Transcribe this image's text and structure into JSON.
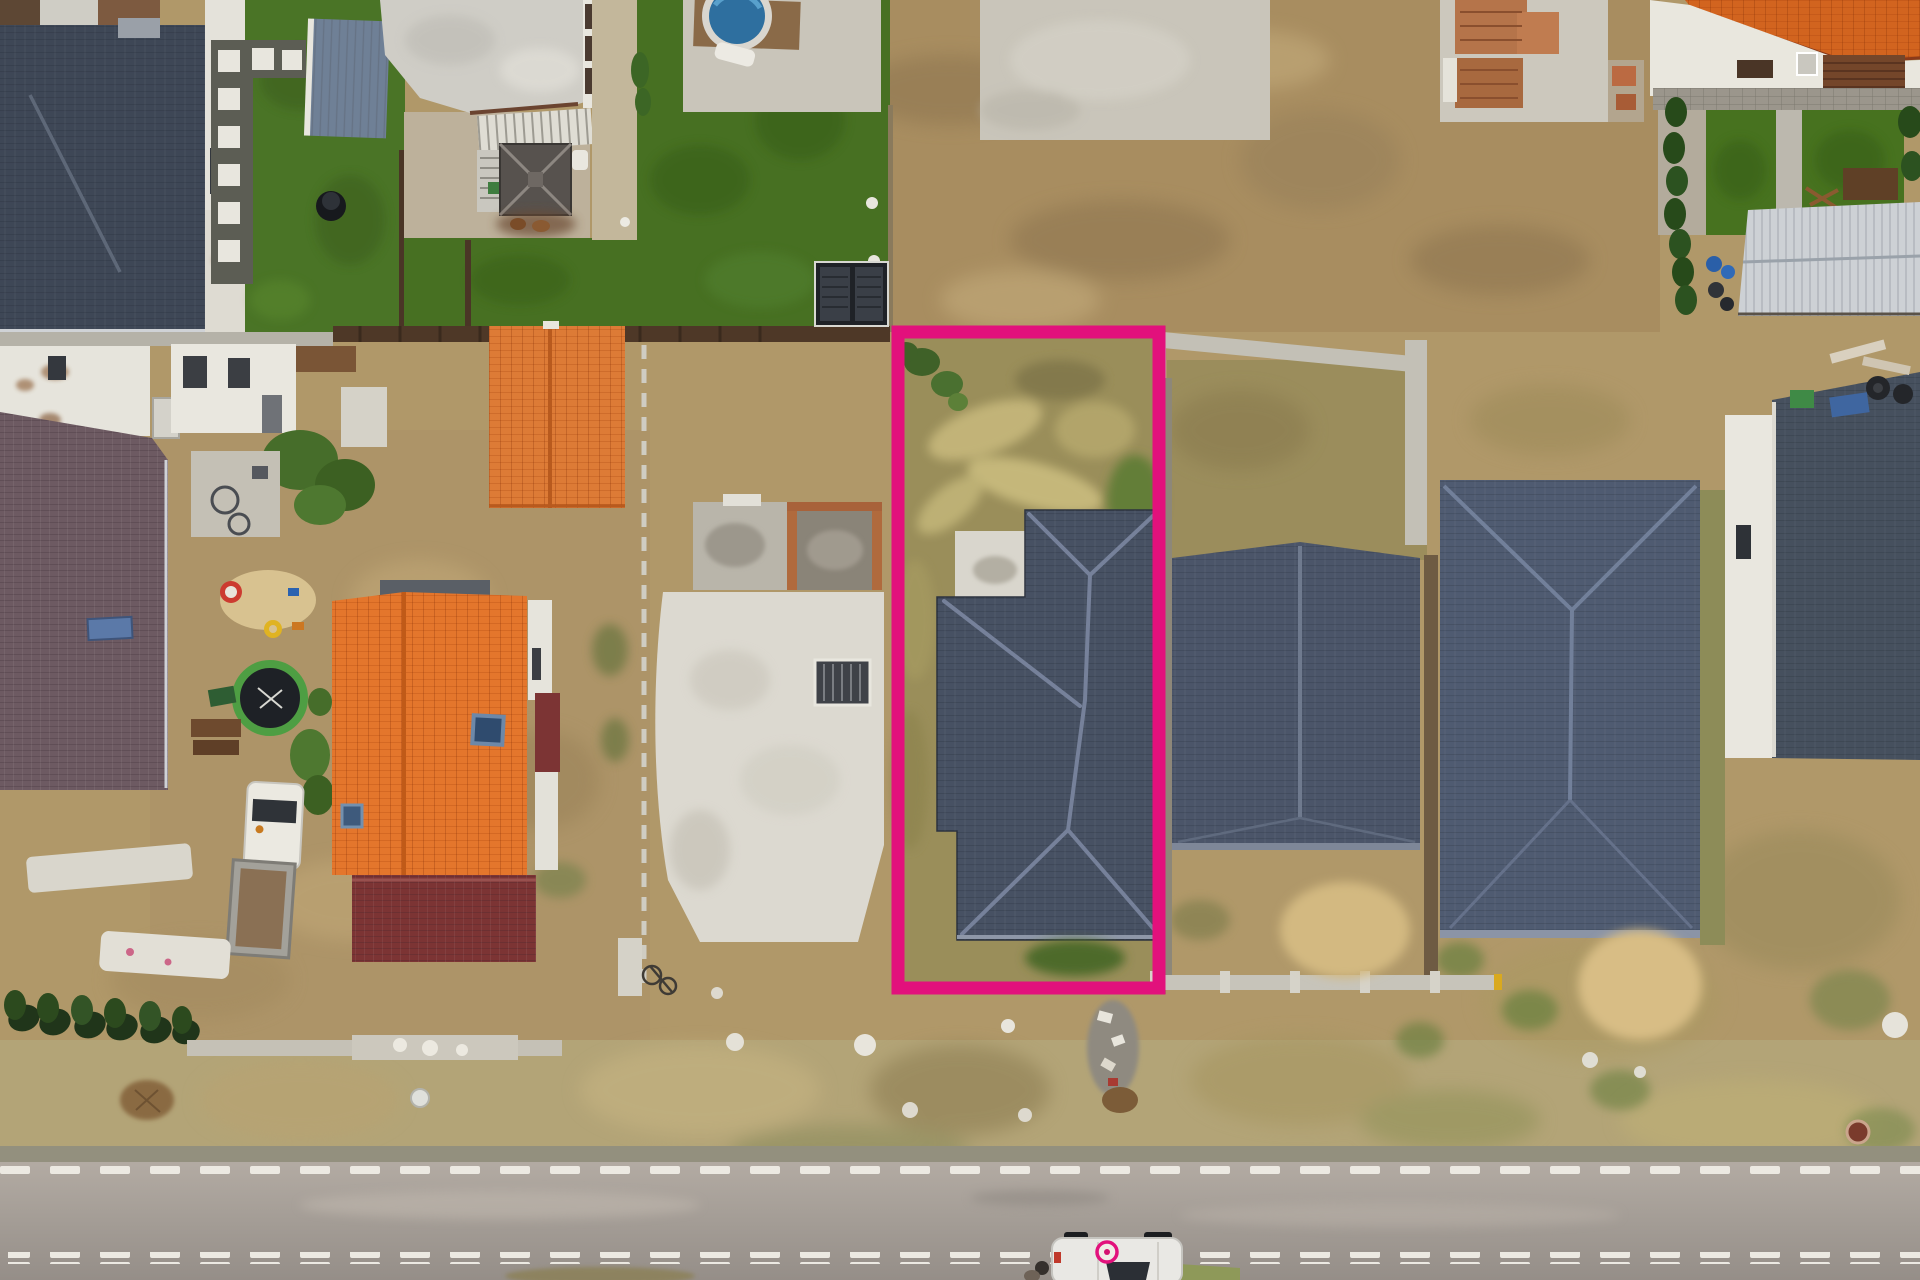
{
  "scene": {
    "type": "aerial-drone-photograph",
    "setting": "suburban residential street with new houses and empty plots, dry late-summer ground",
    "highlight": {
      "label": "for-sale plot boundary outline",
      "shape": "rectangle",
      "color": "#e2117c"
    },
    "road": {
      "surface": "asphalt",
      "dashed_marking_lines": 2,
      "marking_color": "#ece9e2"
    },
    "vehicles": [
      {
        "label": "white car parked on road",
        "roof_logo_color": "#d4126f"
      },
      {
        "label": "white truck with flatbed trailer in yard"
      }
    ],
    "features": [
      "dark-tile hip roof house top-left",
      "green lawns with stepping-stone path",
      "round pool on concrete pad",
      "black solar shed",
      "highlighted plot with house under construction (dark roof)",
      "two large dark-roof neighbor houses",
      "white house with dark roof far right",
      "big orange-tile roof house",
      "small orange-tile shed",
      "purple-brown tile roof house",
      "maroon porch roof",
      "concrete foundations and white slab under construction",
      "brick-walled foundation box",
      "trampoline, sandbox toys, fire-pit patio",
      "cypress hedges",
      "silver metal shed with garden",
      "brick pallets on concrete pad",
      "manhole cover, white stones, junk pile"
    ]
  },
  "palette": {
    "boundary_pink": "#e2117c",
    "dry_ground": "#b09869",
    "dry_grass_light": "#cbb684",
    "lawn_green": "#4a7426",
    "roof_dark_slate": "#475163",
    "roof_orange": "#e4762c",
    "roof_maroon": "#7c3434",
    "roof_purple_brown": "#6d5a62",
    "road_asphalt": "#a49d96",
    "marking_white": "#ece9e2",
    "concrete_light": "#c9c5ba",
    "slab_white": "#dcd9d0",
    "pool_water": "#2e6f9f",
    "fence_brown": "#4e3827"
  }
}
